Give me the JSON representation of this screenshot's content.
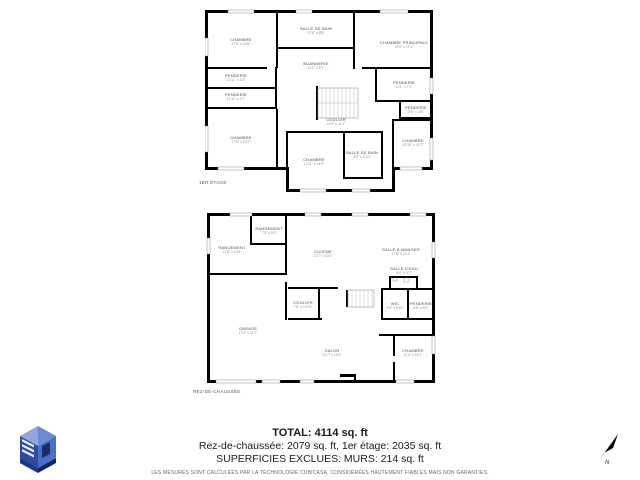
{
  "plans": [
    {
      "label": "1ER ÉTAGE",
      "rooms": [
        {
          "name": "CHAMBRE",
          "dims": "17'6\" x 14'8\""
        },
        {
          "name": "SALLE DE BAIN",
          "dims": "17'6\" x 8'8\""
        },
        {
          "name": "CHAMBRE PRINCIPALE",
          "dims": "19'9\" x 17'1\""
        },
        {
          "name": "BUANDERIE",
          "dims": "11'2\" x 8'1\""
        },
        {
          "name": "PENDERIE",
          "dims": "11'11\" x 3'3\""
        },
        {
          "name": "PENDERIE",
          "dims": "11'11\" x 3'7\""
        },
        {
          "name": "PENDERIE",
          "dims": "11'1\" x 7'1\""
        },
        {
          "name": "PENDERIE",
          "dims": "8'5\" x 3'8\""
        },
        {
          "name": "COULOIR",
          "dims": "24'9\" x 11'1\""
        },
        {
          "name": "CHAMBRE",
          "dims": "17'6\" x 14'7\""
        },
        {
          "name": "CHAMBRE",
          "dims": "11'11\" x 14'9\""
        },
        {
          "name": "SALLE DE BAIN",
          "dims": "8'9\" x 5'10\""
        },
        {
          "name": "CHAMBRE",
          "dims": "13'10\" x 11'7\""
        }
      ]
    },
    {
      "label": "REZ-DE-CHAUSSÉE",
      "rooms": [
        {
          "name": "RANGEMENT",
          "dims": "11'8\" x 13'9\""
        },
        {
          "name": "RANGEMENT",
          "dims": "7'5\" x 5'0\""
        },
        {
          "name": "CUISINE",
          "dims": "17'7\" x 13'3\""
        },
        {
          "name": "SALLE À MANGER",
          "dims": "17'8\" x 12'1\""
        },
        {
          "name": "SALLE D'EAU",
          "dims": "6'4\" x 3'7\""
        },
        {
          "name": "COULOIR",
          "dims": "7'6\" x 14'10\""
        },
        {
          "name": "WIC",
          "dims": "7'0\" x 5'10\""
        },
        {
          "name": "PENDERIE",
          "dims": "6'5\" x 6'9\""
        },
        {
          "name": "GARAGE",
          "dims": "17'4\" x 21'7\""
        },
        {
          "name": "SALON",
          "dims": "22'7\" x 15'9\""
        },
        {
          "name": "CHAMBRE",
          "dims": "11'2\" x 14'7\""
        }
      ]
    }
  ],
  "summary": {
    "total": "TOTAL: 4114 sq. ft",
    "floors_line": "Rez-de-chaussée: 2079 sq. ft, 1er étage: 2035 sq. ft",
    "excluded_line": "SUPERFICIES EXCLUES: MURS: 214 sq. ft",
    "disclaimer": "LES MESURES SONT CALCULÉES PAR LA TECHNOLOGIE CUBICASA, CONSIDÉRÉES HAUTEMENT FIABLES MAIS NON GARANTIES."
  },
  "compass": {
    "label": "N"
  },
  "colors": {
    "wall": "#000000",
    "window_line": "#8a8a8a",
    "stairs_line": "#bbbbbb",
    "logo_light": "#8fa6dd",
    "logo_mid": "#4a6fc4",
    "logo_dark": "#2e4da0",
    "logo_navy": "#1a2d66"
  }
}
